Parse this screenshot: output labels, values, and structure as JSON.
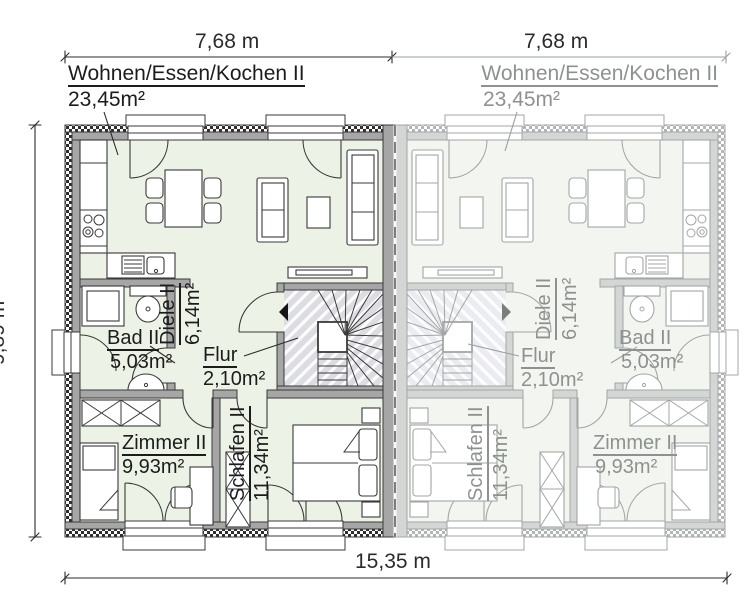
{
  "plan": {
    "dimensions": {
      "width_left": "7,68 m",
      "width_right": "7,68 m",
      "height": "9,89 m",
      "total_width": "15,35 m"
    },
    "rooms": {
      "living": {
        "name": "Wohnen/Essen/Kochen II",
        "area": "23,45m²"
      },
      "hall": {
        "name": "Diele II",
        "area": "6,14m²"
      },
      "corridor": {
        "name": "Flur",
        "area": "2,10m²"
      },
      "bath": {
        "name": "Bad II",
        "area": "5,03m²"
      },
      "room": {
        "name": "Zimmer II",
        "area": "9,93m²"
      },
      "bedroom": {
        "name": "Schlafen II",
        "area": "11,34m²"
      }
    },
    "colors": {
      "left_unit_line": "#3a3a3a",
      "right_unit_line": "#a2a7a5",
      "floor": "#edf2e7",
      "wall_fill": "#a6a6a6",
      "stair_floor": "#dcdce3"
    }
  }
}
